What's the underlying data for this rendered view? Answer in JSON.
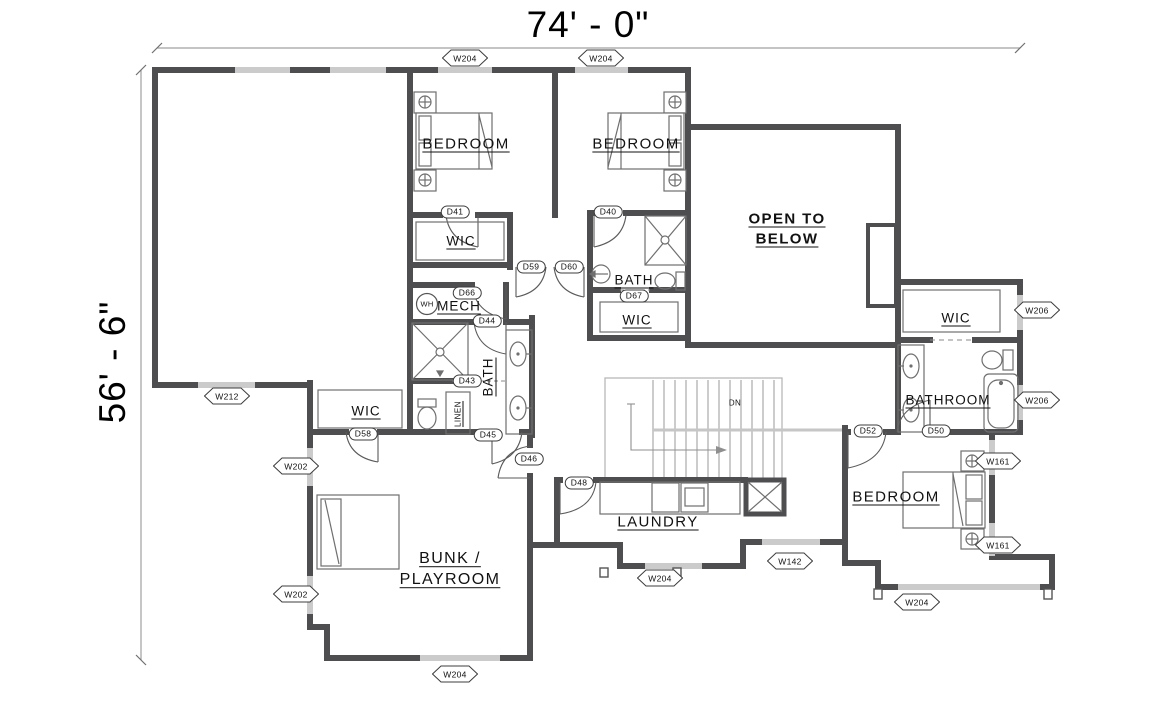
{
  "dimensions": {
    "width_label": "74' - 0\"",
    "height_label": "56' - 6\""
  },
  "rooms": {
    "bedroom_top_left": "BEDROOM",
    "bedroom_top_right": "BEDROOM",
    "open_to_below": "OPEN TO BELOW",
    "wic_top": "WIC",
    "wic_middle": "WIC",
    "wic_left": "WIC",
    "wic_right": "WIC",
    "bath_middle": "BATH",
    "bath_upper": "BATH",
    "mech": "MECH",
    "bathroom_right": "BATHROOM",
    "bedroom_bottom_right": "BEDROOM",
    "laundry": "LAUNDRY",
    "bunk_playroom": "BUNK / PLAYROOM",
    "linen": "LINEN",
    "water_heater": "WH",
    "stairs_direction": "DN"
  },
  "door_tags": [
    "D41",
    "D40",
    "D59",
    "D60",
    "D66",
    "D44",
    "D43",
    "D67",
    "D58",
    "D45",
    "D46",
    "D48",
    "D52",
    "D50"
  ],
  "window_tags": [
    "W204",
    "W204",
    "W212",
    "W202",
    "W202",
    "W204",
    "W204",
    "W142",
    "W204",
    "W161",
    "W161",
    "W206",
    "W206"
  ],
  "colors": {
    "wall": "#4e4e50",
    "window": "#cbcbcb",
    "dimension_line": "#a0a0a0",
    "text": "#111111"
  }
}
